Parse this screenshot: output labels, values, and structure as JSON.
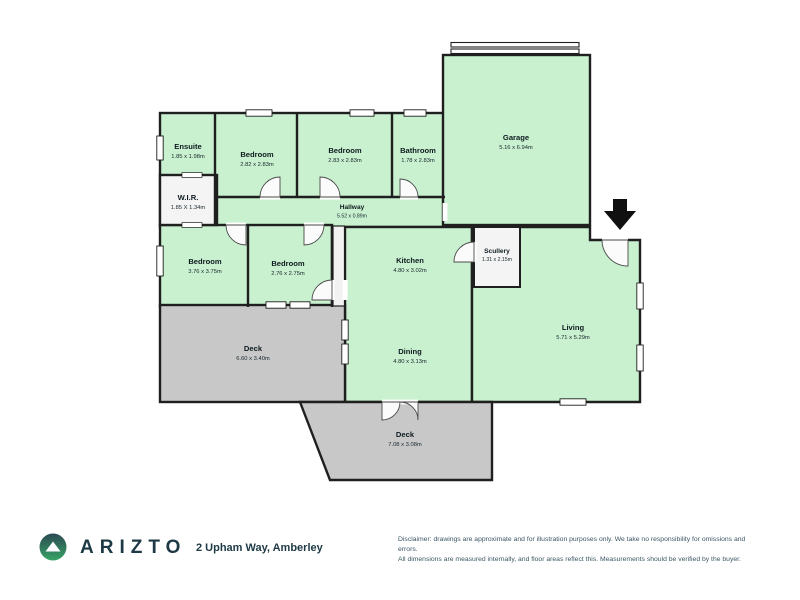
{
  "brand": "ARIZTO",
  "address": "2 Upham Way, Amberley",
  "disclaimer": {
    "line1": "Disclaimer: drawings are approximate and for illustration purposes only. We take no responsibility for omissions and errors.",
    "line2": "All dimensions are measured internally, and floor areas reflect this. Measurements should be verified by the buyer."
  },
  "colors": {
    "room_fill": "#c9f1cf",
    "utility_room_fill": "#f4f4f4",
    "deck_fill": "#c8c8c8",
    "wall": "#1f1f1f",
    "brand_navy": "#1d3945",
    "logo_gradient_top": "#2c4a54",
    "logo_gradient_bottom": "#37a465"
  },
  "icons": {
    "entry_arrow": "down-arrow",
    "logo_mark": "mountain-in-circle"
  },
  "rooms": [
    {
      "name": "Ensuite",
      "dims": "1.85 x 1.98m"
    },
    {
      "name": "W.I.R.",
      "dims": "1.85 X 1.34m"
    },
    {
      "name": "Bedroom",
      "dims": "2.82 x 2.83m"
    },
    {
      "name": "Bedroom",
      "dims": "2.83 x 2.83m"
    },
    {
      "name": "Bathroom",
      "dims": "1.78 x 2.83m"
    },
    {
      "name": "Garage",
      "dims": "5.16 x 6.94m"
    },
    {
      "name": "Hallway",
      "dims": "5.52 x 0.89m"
    },
    {
      "name": "Bedroom",
      "dims": "3.76 x 3.75m"
    },
    {
      "name": "Bedroom",
      "dims": "2.76 x 2.75m"
    },
    {
      "name": "Kitchen",
      "dims": "4.80 x 3.02m"
    },
    {
      "name": "Scullery",
      "dims": "1.31 x 2.15m"
    },
    {
      "name": "Living",
      "dims": "5.71 x 5.29m"
    },
    {
      "name": "Dining",
      "dims": "4.80 x 3.13m"
    },
    {
      "name": "Deck",
      "dims": "6.60 x 3.40m"
    },
    {
      "name": "Deck",
      "dims": "7.08 x 3.08m"
    }
  ]
}
